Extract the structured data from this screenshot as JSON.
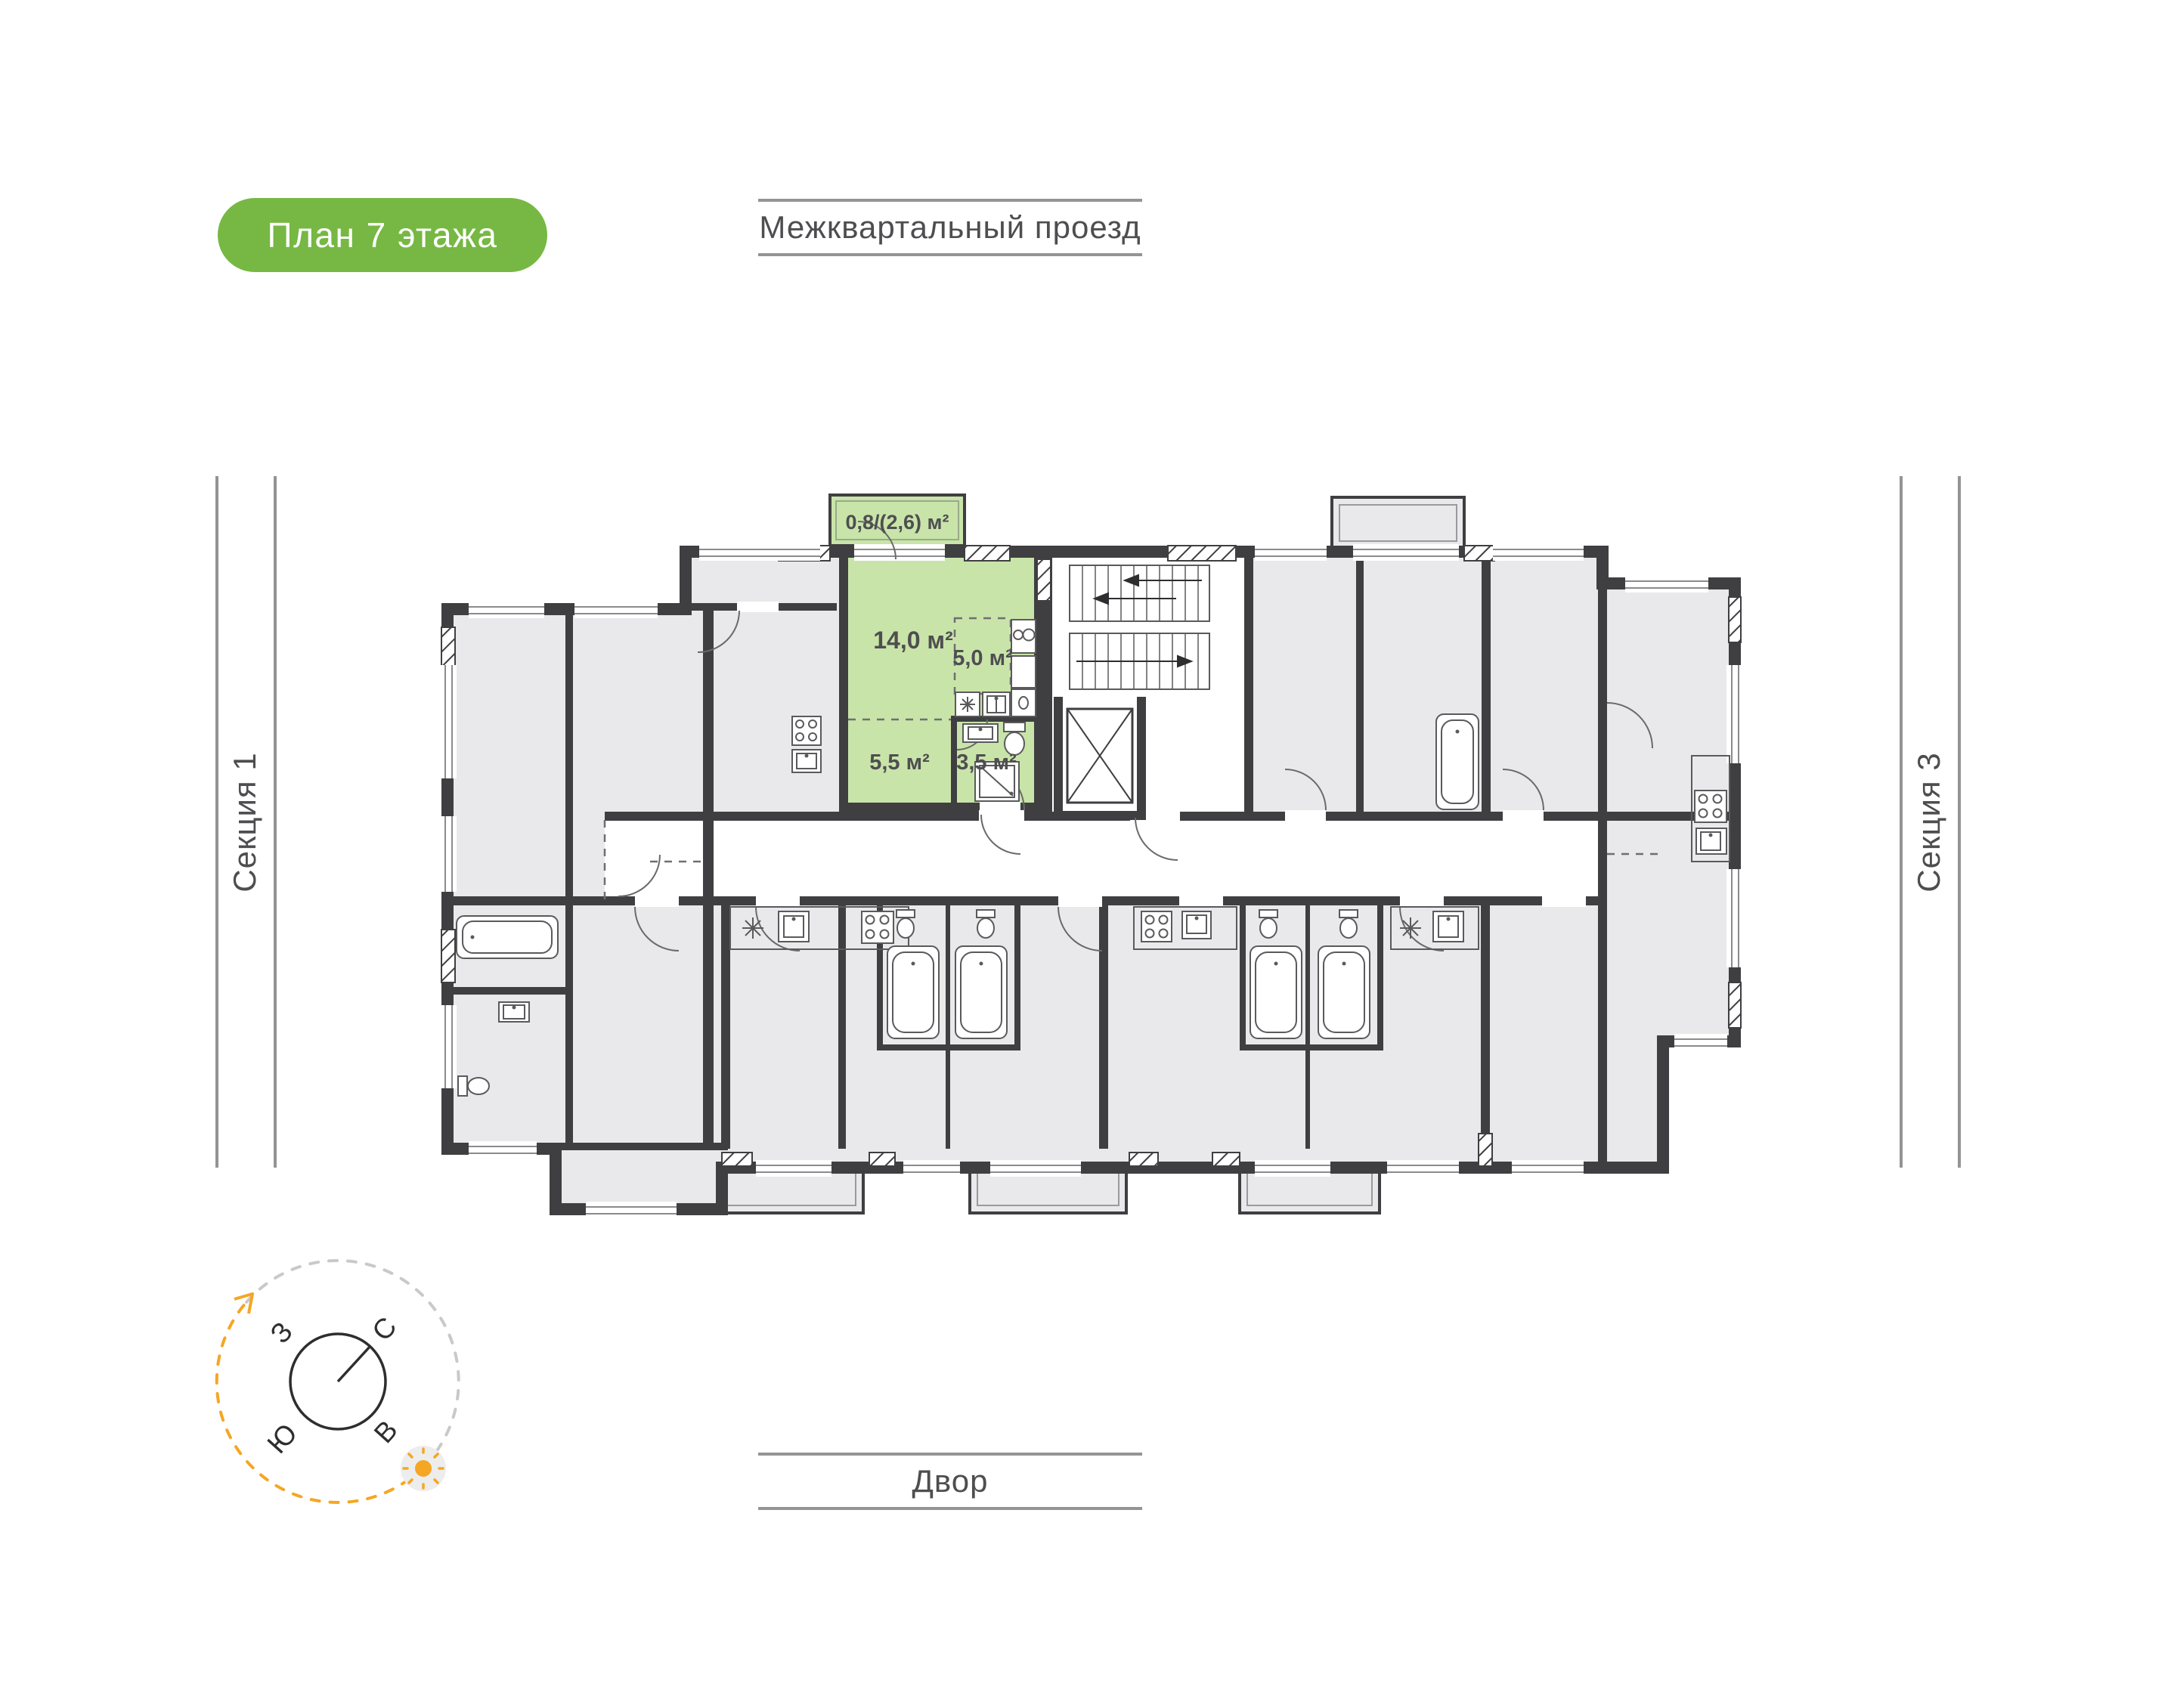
{
  "badge": {
    "label": "План 7 этажа"
  },
  "surroundings": {
    "top_label": "Межквартальный проезд",
    "bottom_label": "Двор",
    "left_label": "Секция 1",
    "right_label": "Секция 3"
  },
  "apartment": {
    "balcony_label": "0,8/(2,6) м²",
    "living_label": "14,0 м²",
    "kitchen_label": "5,0 м²",
    "hall_label": "5,5 м²",
    "bath_label": "3,5 м²"
  },
  "compass": {
    "west": "З",
    "north": "С",
    "south": "Ю",
    "east": "В"
  },
  "colors": {
    "accent_green": "#76b843",
    "apartment_green": "#c9e4a9",
    "wall_dark": "#3f3f41",
    "room_gray": "#e9e9eb",
    "line_gray": "#949496",
    "text_gray": "#4e4e50",
    "sun_orange": "#f5a623"
  }
}
